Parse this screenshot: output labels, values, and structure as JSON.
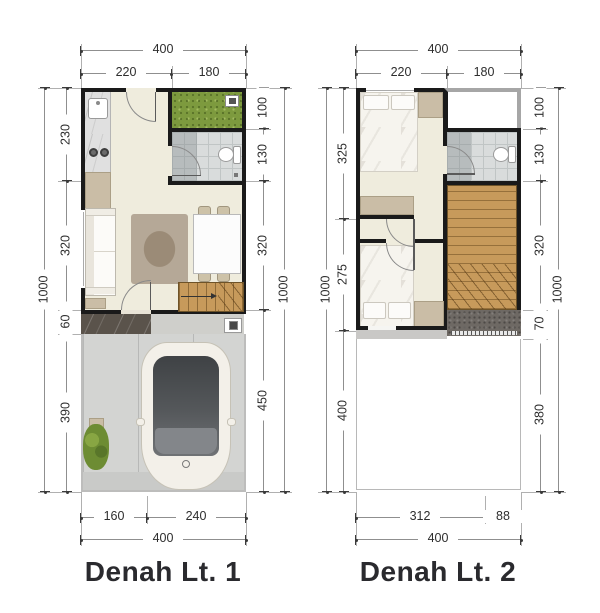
{
  "plans": [
    {
      "title": "Denah Lt. 1",
      "dims": {
        "top_total": "400",
        "top_segments": [
          "220",
          "180"
        ],
        "left_total": "1000",
        "left_segments": [
          "230",
          "320",
          "60",
          "390"
        ],
        "right_segments": [
          "100",
          "130",
          "320",
          "450"
        ],
        "right_total": "1000",
        "bottom_segments": [
          "160",
          "240"
        ],
        "bottom_total": "400"
      }
    },
    {
      "title": "Denah Lt. 2",
      "dims": {
        "top_total": "400",
        "top_segments": [
          "220",
          "180"
        ],
        "left_total": "1000",
        "left_segments": [
          "325",
          "275",
          "400"
        ],
        "right_segments": [
          "100",
          "130",
          "320",
          "70",
          "380"
        ],
        "right_total": "1000",
        "bottom_segments": [
          "312",
          "88"
        ],
        "bottom_total": "400"
      }
    }
  ],
  "colors": {
    "wall": "#1a1a1a",
    "floor": "#efecdd",
    "grass": "#7d9a3e",
    "wood": "#c79a5b",
    "tile": "#d9dcdc",
    "carport": "#d3d4d2",
    "dimension_text": "#2e2e2e",
    "title_text": "#2a2a2e"
  }
}
